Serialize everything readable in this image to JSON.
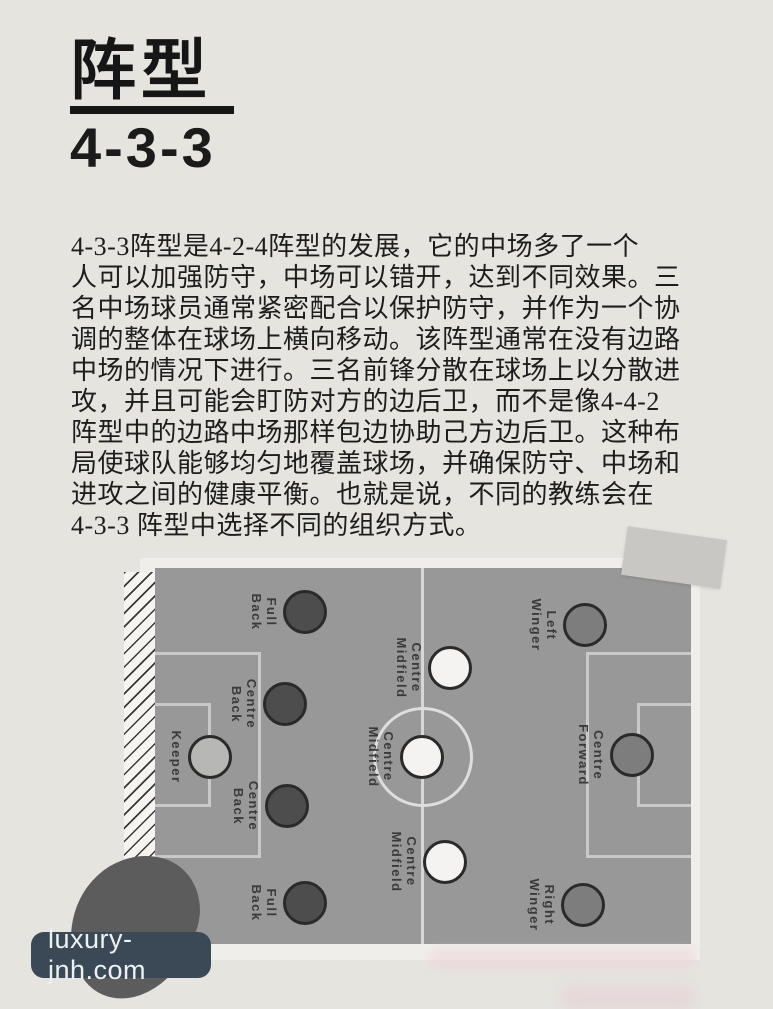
{
  "title": {
    "main": "阵型",
    "sub": "4-3-3"
  },
  "paragraph": {
    "lines": [
      "4-3-3阵型是4-2-4阵型的发展，它的中场多了一个",
      "人可以加强防守，中场可以错开，达到不同效果。三",
      "名中场球员通常紧密配合以保护防守，并作为一个协",
      "调的整体在球场上横向移动。该阵型通常在没有边路",
      "中场的情况下进行。三名前锋分散在球场上以分散进",
      "攻，并且可能会盯防对方的边后卫，而不是像4-4-2",
      "阵型中的边路中场那样包边协助己方边后卫。这种布",
      "局使球队能够均匀地覆盖球场，并确保防守、中场和",
      "进攻之间的健康平衡。也就是说，不同的教练会在",
      "4-3-3 阵型中选择不同的组织方式。"
    ]
  },
  "diagram": {
    "colors": {
      "pitch": "#989898",
      "frame": "#efeeea",
      "line": "#c9c9c7",
      "outline": "#2a2a2a",
      "keeper": "#b7b7b5",
      "defender": "#4d4d4d",
      "midfielder": "#f4f3f1",
      "forward": "#7d7d7d"
    },
    "players": [
      {
        "id": "keeper",
        "role": "keeper",
        "label": "Keeper",
        "x": 70,
        "y": 199
      },
      {
        "id": "full-back-top",
        "role": "defender",
        "label": "Full\nBack",
        "x": 165,
        "y": 54
      },
      {
        "id": "centre-back-top",
        "role": "defender",
        "label": "Centre\nBack",
        "x": 145,
        "y": 146
      },
      {
        "id": "centre-back-bottom",
        "role": "defender",
        "label": "Centre\nBack",
        "x": 147,
        "y": 248
      },
      {
        "id": "full-back-bottom",
        "role": "defender",
        "label": "Full\nBack",
        "x": 165,
        "y": 345
      },
      {
        "id": "centre-midfield-top",
        "role": "midfielder",
        "label": "Centre\nMidfield",
        "x": 310,
        "y": 110
      },
      {
        "id": "centre-midfield-centre",
        "role": "midfielder",
        "label": "Centre\nMidfield",
        "x": 282,
        "y": 199
      },
      {
        "id": "centre-midfield-bottom",
        "role": "midfielder",
        "label": "Centre\nMidfield",
        "x": 305,
        "y": 304
      },
      {
        "id": "left-winger",
        "role": "forward",
        "label": "Left\nWinger",
        "x": 445,
        "y": 67
      },
      {
        "id": "centre-forward",
        "role": "forward",
        "label": "Centre\nForward",
        "x": 492,
        "y": 197
      },
      {
        "id": "right-winger",
        "role": "forward",
        "label": "Right\nWinger",
        "x": 443,
        "y": 347
      }
    ]
  },
  "watermark": {
    "text": "luxury-jnh.com"
  }
}
